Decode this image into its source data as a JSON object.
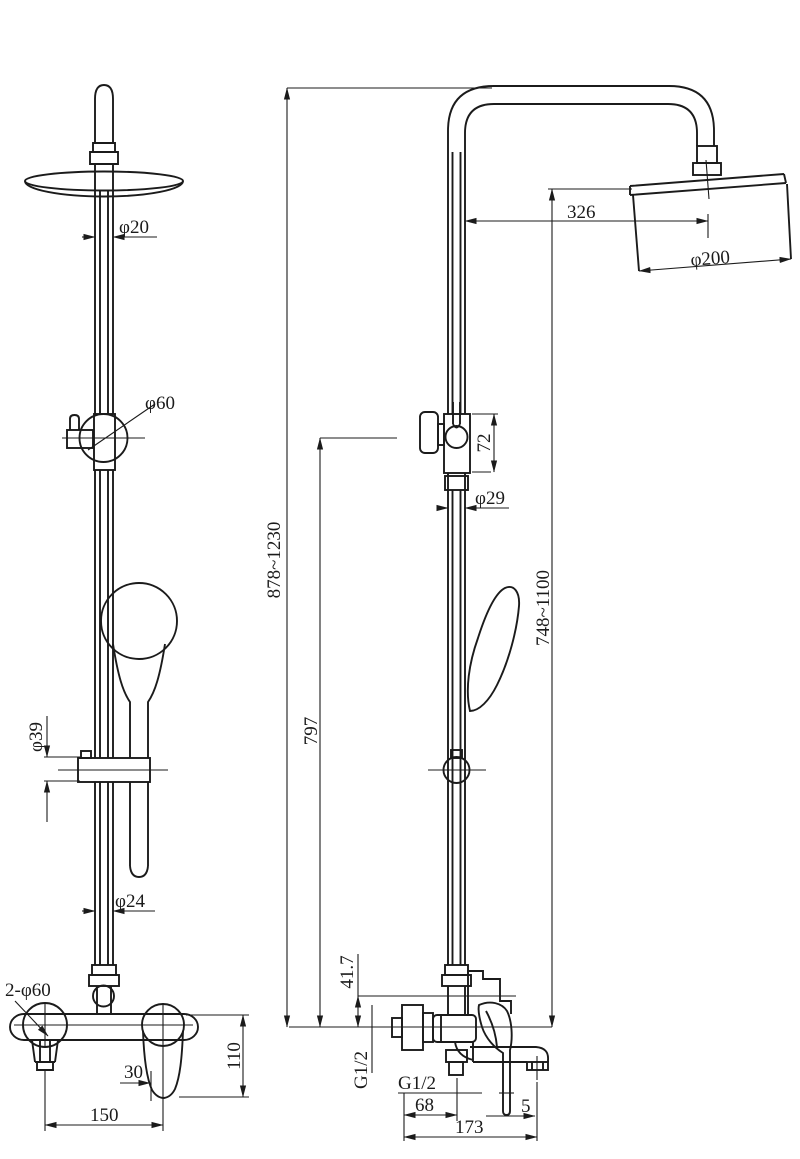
{
  "title": "Shower column set technical drawing",
  "front": {
    "top_pipe_dia": "φ20",
    "slider_knob_dia": "φ60",
    "bracket_dia": "φ39",
    "bottom_pipe_dia": "φ24",
    "wall_holes": "2-φ60",
    "handle_offset": "30",
    "body_height": "110",
    "centers_span": "150"
  },
  "side": {
    "head_reach": "326",
    "head_dia": "φ200",
    "slider_body_height": "72",
    "pipe_dia": "φ29",
    "overall_height": "878~1230",
    "head_center_height": "748~1100",
    "riser_height": "797",
    "spout_axis_offset": "41.7",
    "wall_thread": "G1/2",
    "hose_thread": "G1/2",
    "hose_outlet_reach": "68",
    "aerator_offset": "5",
    "spout_reach": "173"
  }
}
